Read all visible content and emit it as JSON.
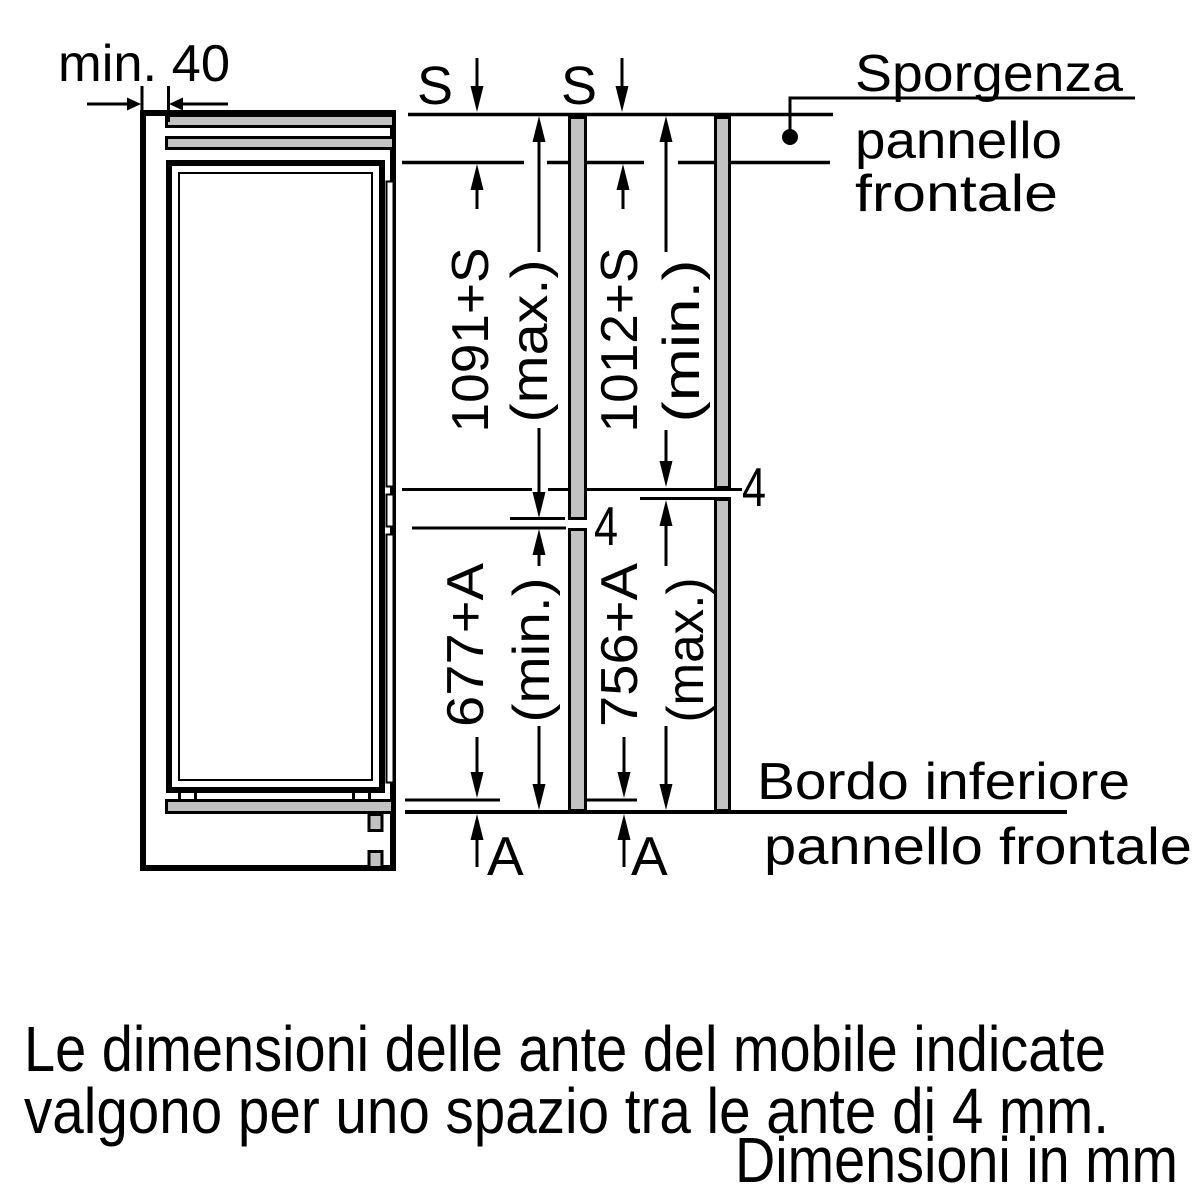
{
  "labels": {
    "min_clearance": "min. 40",
    "s_symbol": "S",
    "a_symbol": "A",
    "gap_value": "4",
    "upper_panel": {
      "max_value": "1091+S",
      "max_qualifier": "(max.)",
      "min_value": "1012+S",
      "min_qualifier": "(min.)"
    },
    "lower_panel": {
      "min_value": "677+A",
      "min_qualifier": "(min.)",
      "max_value": "756+A",
      "max_qualifier": "(max.)"
    },
    "callout_top": {
      "line1": "Sporgenza",
      "line2": "pannello",
      "line3": "frontale"
    },
    "callout_bottom": {
      "line1": "Bordo inferiore",
      "line2": "pannello frontale"
    }
  },
  "footer": {
    "note_line1": "Le dimensioni delle ante del mobile indicate",
    "note_line2": "valgono per uno spazio tra le ante di 4 mm.",
    "units": "Dimensioni in mm"
  },
  "colors": {
    "ink": "#000000",
    "panel_fill": "#c2c2c2",
    "background": "#ffffff"
  }
}
